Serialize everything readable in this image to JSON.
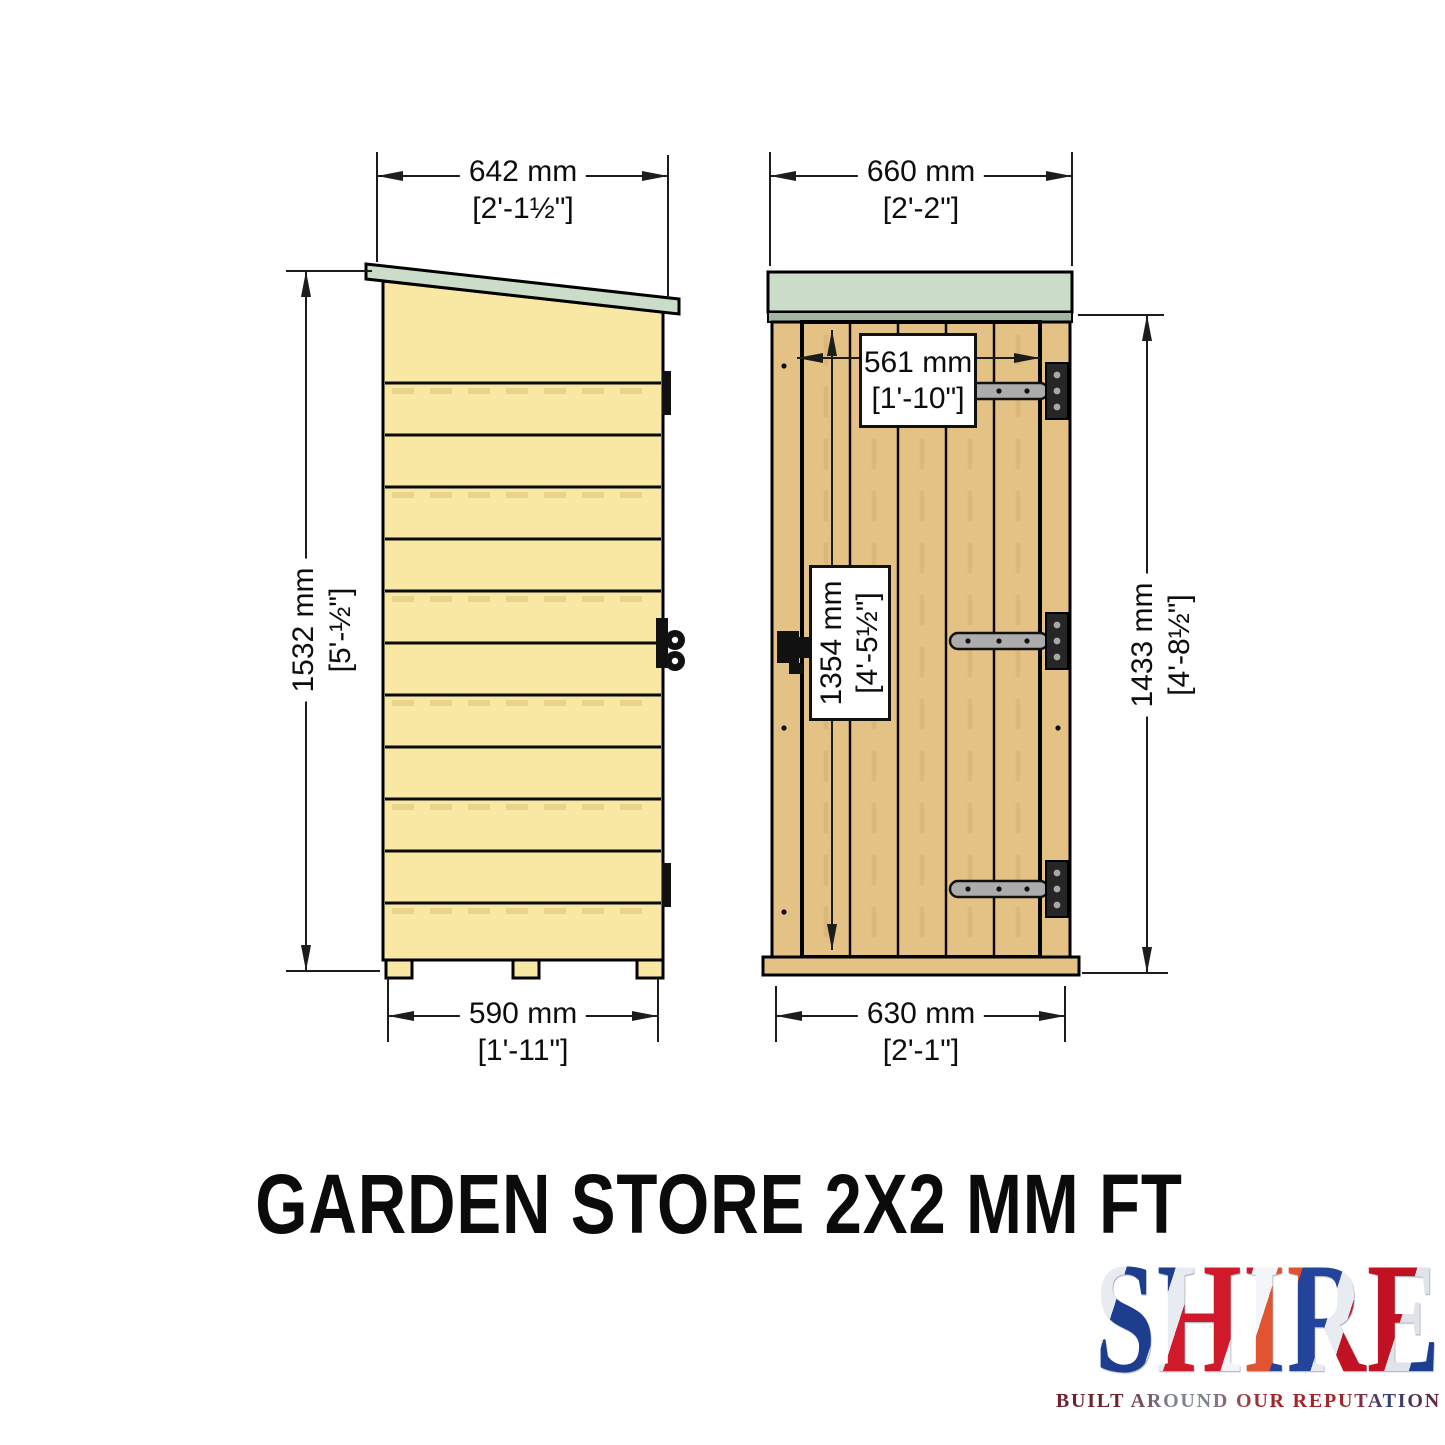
{
  "title": {
    "text": "GARDEN STORE 2X2 MM FT"
  },
  "logo": {
    "brand": "SHIRE",
    "tagline": "BUILT AROUND OUR REPUTATION"
  },
  "dimensions": {
    "side_width": {
      "mm": "642 mm",
      "ftin": "[2'-1½\"]"
    },
    "front_width": {
      "mm": "660 mm",
      "ftin": "[2'-2\"]"
    },
    "side_height": {
      "mm": "1532 mm",
      "ftin": "[5'-½\"]"
    },
    "front_height": {
      "mm": "1433 mm",
      "ftin": "[4'-8½\"]"
    },
    "door_width": {
      "mm": "561 mm",
      "ftin": "[1'-10\"]"
    },
    "door_height": {
      "mm": "1354 mm",
      "ftin": "[4'-5½\"]"
    },
    "side_base": {
      "mm": "590 mm",
      "ftin": "[1'-11\"]"
    },
    "front_base": {
      "mm": "630 mm",
      "ftin": "[2'-1\"]"
    }
  },
  "colors": {
    "wood_light": "#F8E8A4",
    "wood_tan": "#E4C285",
    "roof": "#CBDCC9",
    "roof_fascia": "#A2B5A3",
    "hinge_metal": "#ACACAC",
    "line": "#1C1C1C"
  }
}
